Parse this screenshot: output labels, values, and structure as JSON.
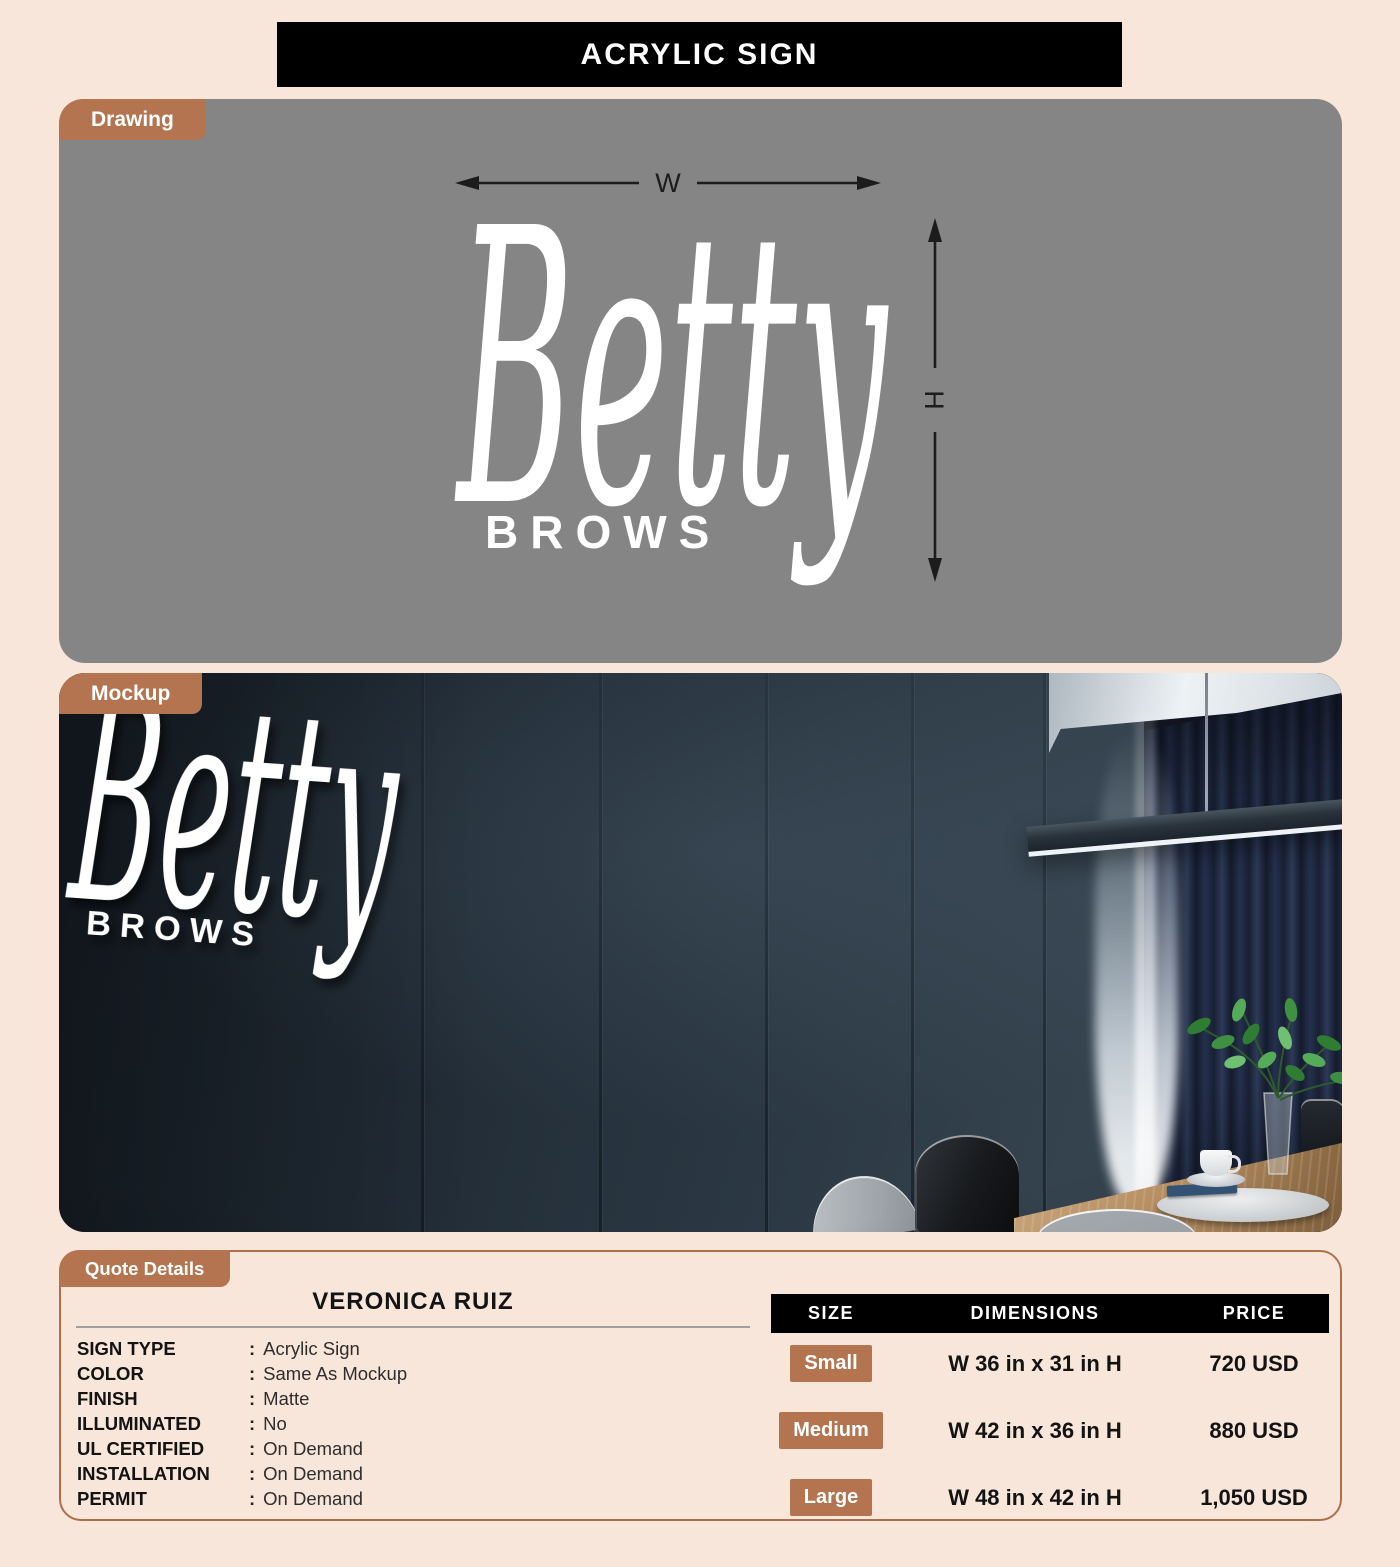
{
  "banner": {
    "title": "ACRYLIC SIGN"
  },
  "sections": {
    "drawing": {
      "tab": "Drawing",
      "width_label": "W",
      "height_label": "H"
    },
    "mockup": {
      "tab": "Mockup"
    },
    "quote": {
      "tab": "Quote Details"
    }
  },
  "sign": {
    "script": "Betty",
    "caps": "BROWS"
  },
  "quote": {
    "customer_name": "VERONICA RUIZ",
    "separator": ":",
    "fields": [
      {
        "label": "SIGN TYPE",
        "value": "Acrylic Sign"
      },
      {
        "label": "COLOR",
        "value": "Same As Mockup"
      },
      {
        "label": "FINISH",
        "value": "Matte"
      },
      {
        "label": "ILLUMINATED",
        "value": "No"
      },
      {
        "label": "UL CERTIFIED",
        "value": "On Demand"
      },
      {
        "label": "INSTALLATION",
        "value": "On Demand"
      },
      {
        "label": "PERMIT",
        "value": "On Demand"
      }
    ],
    "price_table": {
      "headers": {
        "size": "SIZE",
        "dimensions": "DIMENSIONS",
        "price": "PRICE"
      },
      "rows": [
        {
          "size": "Small",
          "dimensions": "W 36 in x 31 in H",
          "price": "720 USD"
        },
        {
          "size": "Medium",
          "dimensions": "W 42 in x 36 in H",
          "price": "880 USD"
        },
        {
          "size": "Large",
          "dimensions": "W 48 in x 42 in H",
          "price": "1,050 USD"
        }
      ]
    }
  },
  "colors": {
    "page_bg": "#f8e6da",
    "accent": "#b3744f",
    "banner_bg": "#000000",
    "drawing_bg": "#858585",
    "text_dark": "#1c1c1c"
  }
}
